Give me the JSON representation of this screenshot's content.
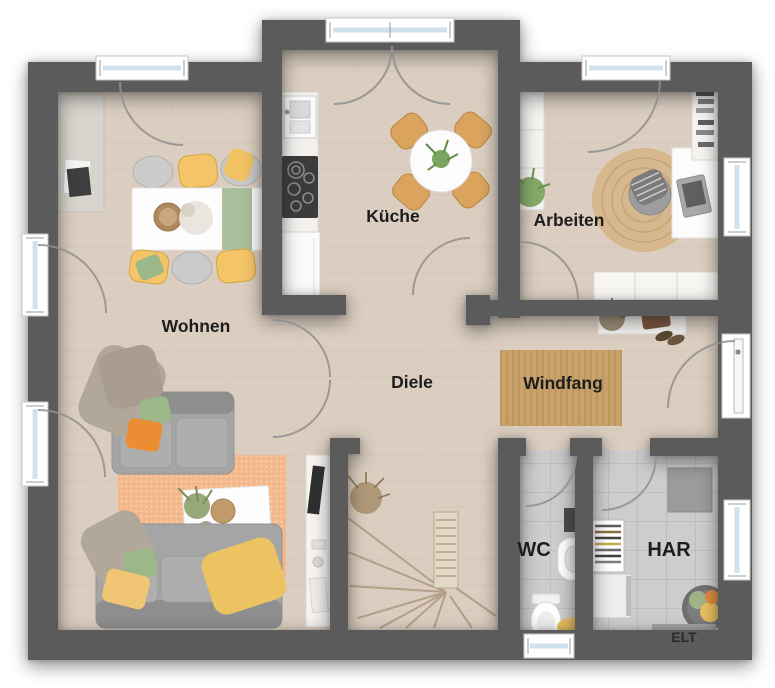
{
  "rooms": {
    "wohnen": {
      "label": "Wohnen"
    },
    "kueche": {
      "label": "Küche"
    },
    "arbeiten": {
      "label": "Arbeiten"
    },
    "diele": {
      "label": "Diele"
    },
    "windfang": {
      "label": "Windfang"
    },
    "wc": {
      "label": "WC"
    },
    "har": {
      "label": "HAR"
    },
    "elt": {
      "label": "ELT"
    }
  },
  "colors": {
    "wall": "#5b5b5b",
    "wood": "#dbcec0",
    "tile": "#cdcdcd",
    "glass": "#cfe2ee",
    "label": "#1d1d1d",
    "rug_orange": "#f4b98c",
    "rug_jute": "#d7b78d",
    "mat_jute": "#c9a26b",
    "chair_yellow": "#f3c468",
    "chair_wood": "#dba45e",
    "sofa_gray": "#a5a5a5",
    "pillow_orange": "#ec8d33",
    "pillow_green": "#9cb788",
    "blanket_yellow": "#edc262"
  }
}
